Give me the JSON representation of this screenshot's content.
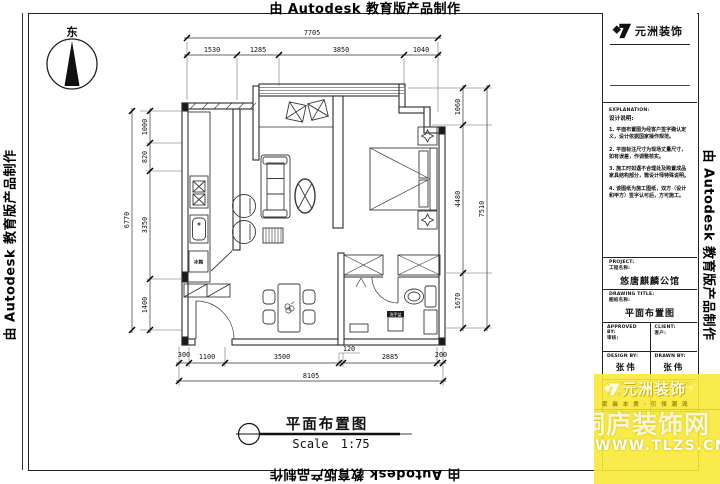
{
  "watermark": {
    "autodesk": "由 Autodesk 教育版产品制作"
  },
  "compass": {
    "label": "东"
  },
  "plan": {
    "labels": {
      "fridge": "冰箱",
      "basin": "洗手盆"
    }
  },
  "dimensions": {
    "top": {
      "overall": "7705",
      "segments": [
        "1530",
        "1285",
        "3850",
        "1040"
      ]
    },
    "left": {
      "overall": "6770",
      "segments": [
        "1000",
        "820",
        "3350",
        "1400"
      ]
    },
    "right": {
      "overall": "7510",
      "segments": [
        "1060",
        "4480",
        "1670"
      ]
    },
    "bottom": {
      "overall": "8105",
      "segments": [
        "300",
        "1100",
        "3500",
        "120",
        "2885",
        "200"
      ]
    }
  },
  "drawing_caption": {
    "title": "平面布置图",
    "scale": "Scale 1:75"
  },
  "title_block": {
    "company": "元洲装饰",
    "explanation_en": "EXPLANATION:",
    "explanation_cn": "设计说明:",
    "notes": [
      "1. 平面布置图为经客户签字确认定义，设计依据国家操作规范。",
      "2. 平面标注尺寸为现场丈量尺寸，如有误差，作调整核实。",
      "3. 施工时如遇不合理处及购置成品家具结构部分，需设计师特殊说明。",
      "4. 该图纸为施工图纸，双方（设计和甲方）签字认可后，方可施工。"
    ],
    "project_en": "PROJECT:",
    "project_cn": "工程名称:",
    "project_name": "悠唐麒麟公馆",
    "drawing_en": "DRAWING TITLE:",
    "drawing_cn": "图纸名称:",
    "drawing_name": "平面布置图",
    "approved_en": "APPROVED BY:",
    "approved_cn": "审核:",
    "client_en": "CLIENT:",
    "client_cn": "客户:",
    "design_en": "DESIGN BY:",
    "design_cn": "设计:",
    "designer": "张伟",
    "drawn_en": "DRAWN BY:",
    "drawn_cn": "制图:",
    "drafter": "张伟",
    "contract_en": "CONTRACT NO:",
    "contract_cn": "合同号:",
    "drawingno_en": "DRAWING NO:",
    "drawingno_cn": "图号:"
  },
  "site_watermark": {
    "brand": "元洲装饰",
    "reg": "®",
    "slogan": "家 装 本 质 · 引 领 潮 流",
    "site_name": "桐庐装饰网",
    "site_url": "WWW.TLZS.CN",
    "yellow": "#f7e937"
  }
}
